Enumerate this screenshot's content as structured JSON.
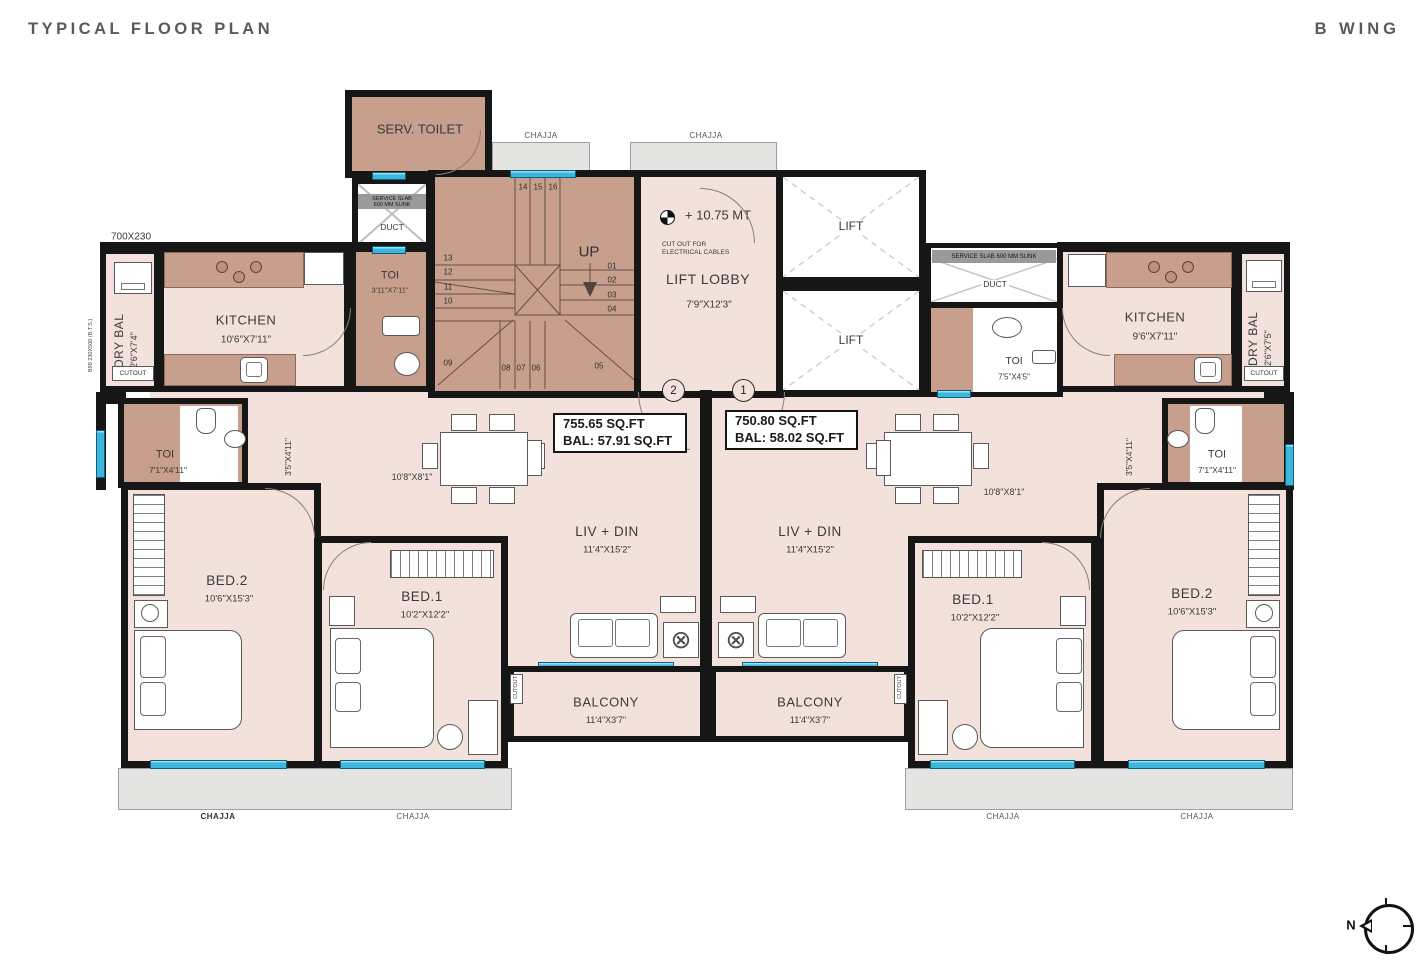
{
  "header": {
    "title": "TYPICAL FLOOR PLAN",
    "wing": "B WING"
  },
  "compass": {
    "north": "N"
  },
  "common": {
    "chajja": "CHAJJA",
    "cutout": "CUTOUT",
    "duct": "DUCT",
    "service_slab": "SERVICE SLAB 600 MM SUNK",
    "service_slab_l1": "SERVICE SLAB",
    "service_slab_l2": "600 MM SUNK",
    "lift": "LIFT",
    "up": "UP"
  },
  "core": {
    "serv_toilet": "SERV. TOILET",
    "lift_lobby": {
      "name": "LIFT LOBBY",
      "dim": "7'9\"X12'3\"",
      "level": "+ 10.75 MT",
      "note1": "CUT OUT FOR",
      "note2": "ELECTRICAL CABLES"
    },
    "toi": {
      "name": "TOI",
      "dim": "7'5\"X4'5\""
    },
    "stairs": {
      "top": [
        "14",
        "15",
        "16"
      ],
      "left": [
        "13",
        "12",
        "11",
        "10"
      ],
      "right": [
        "01",
        "02",
        "03",
        "04"
      ],
      "bottom": [
        "09",
        "08",
        "07",
        "06",
        "05"
      ]
    }
  },
  "annotations": {
    "lintel": "700X230",
    "beam": "B99 230X500 (B.T.S.)"
  },
  "flat2": {
    "unit": "2",
    "area": "755.65 SQ.FT",
    "bal_area": "BAL: 57.91 SQ.FT",
    "dry_bal": {
      "name": "DRY BAL",
      "dim": "2'6\"X7'4\""
    },
    "kitchen": {
      "name": "KITCHEN",
      "dim": "10'6\"X7'11\""
    },
    "toi_attached": {
      "name": "TOI",
      "dim": "3'11\"X7'11\""
    },
    "toi": {
      "name": "TOI",
      "dim": "7'1\"X4'11\""
    },
    "passage": "3'5\"X4'11\"",
    "dining": "10'8\"X8'1\"",
    "livdin": {
      "name": "LIV + DIN",
      "dim": "11'4\"X15'2\""
    },
    "bed1": {
      "name": "BED.1",
      "dim": "10'2\"X12'2\""
    },
    "bed2": {
      "name": "BED.2",
      "dim": "10'6\"X15'3\""
    },
    "balcony": {
      "name": "BALCONY",
      "dim": "11'4\"X3'7\""
    }
  },
  "flat1": {
    "unit": "1",
    "area": "750.80 SQ.FT",
    "bal_area": "BAL: 58.02 SQ.FT",
    "dry_bal": {
      "name": "DRY BAL",
      "dim": "2'6\"X7'5\""
    },
    "kitchen": {
      "name": "KITCHEN",
      "dim": "9'6\"X7'11\""
    },
    "toi": {
      "name": "TOI",
      "dim": "7'1\"X4'11\""
    },
    "passage": "3'5\"X4'11\"",
    "dining": "10'8\"X8'1\"",
    "livdin": {
      "name": "LIV + DIN",
      "dim": "11'4\"X15'2\""
    },
    "bed1": {
      "name": "BED.1",
      "dim": "10'2\"X12'2\""
    },
    "bed2": {
      "name": "BED.2",
      "dim": "10'6\"X15'3\""
    },
    "balcony": {
      "name": "BALCONY",
      "dim": "11'4\"X3'7\""
    }
  },
  "colors": {
    "wall": "#161616",
    "room": "#f2e2db",
    "wet_area": "#c89e8c",
    "window": "#3eb5da",
    "chajja": "#e4e4e3"
  }
}
